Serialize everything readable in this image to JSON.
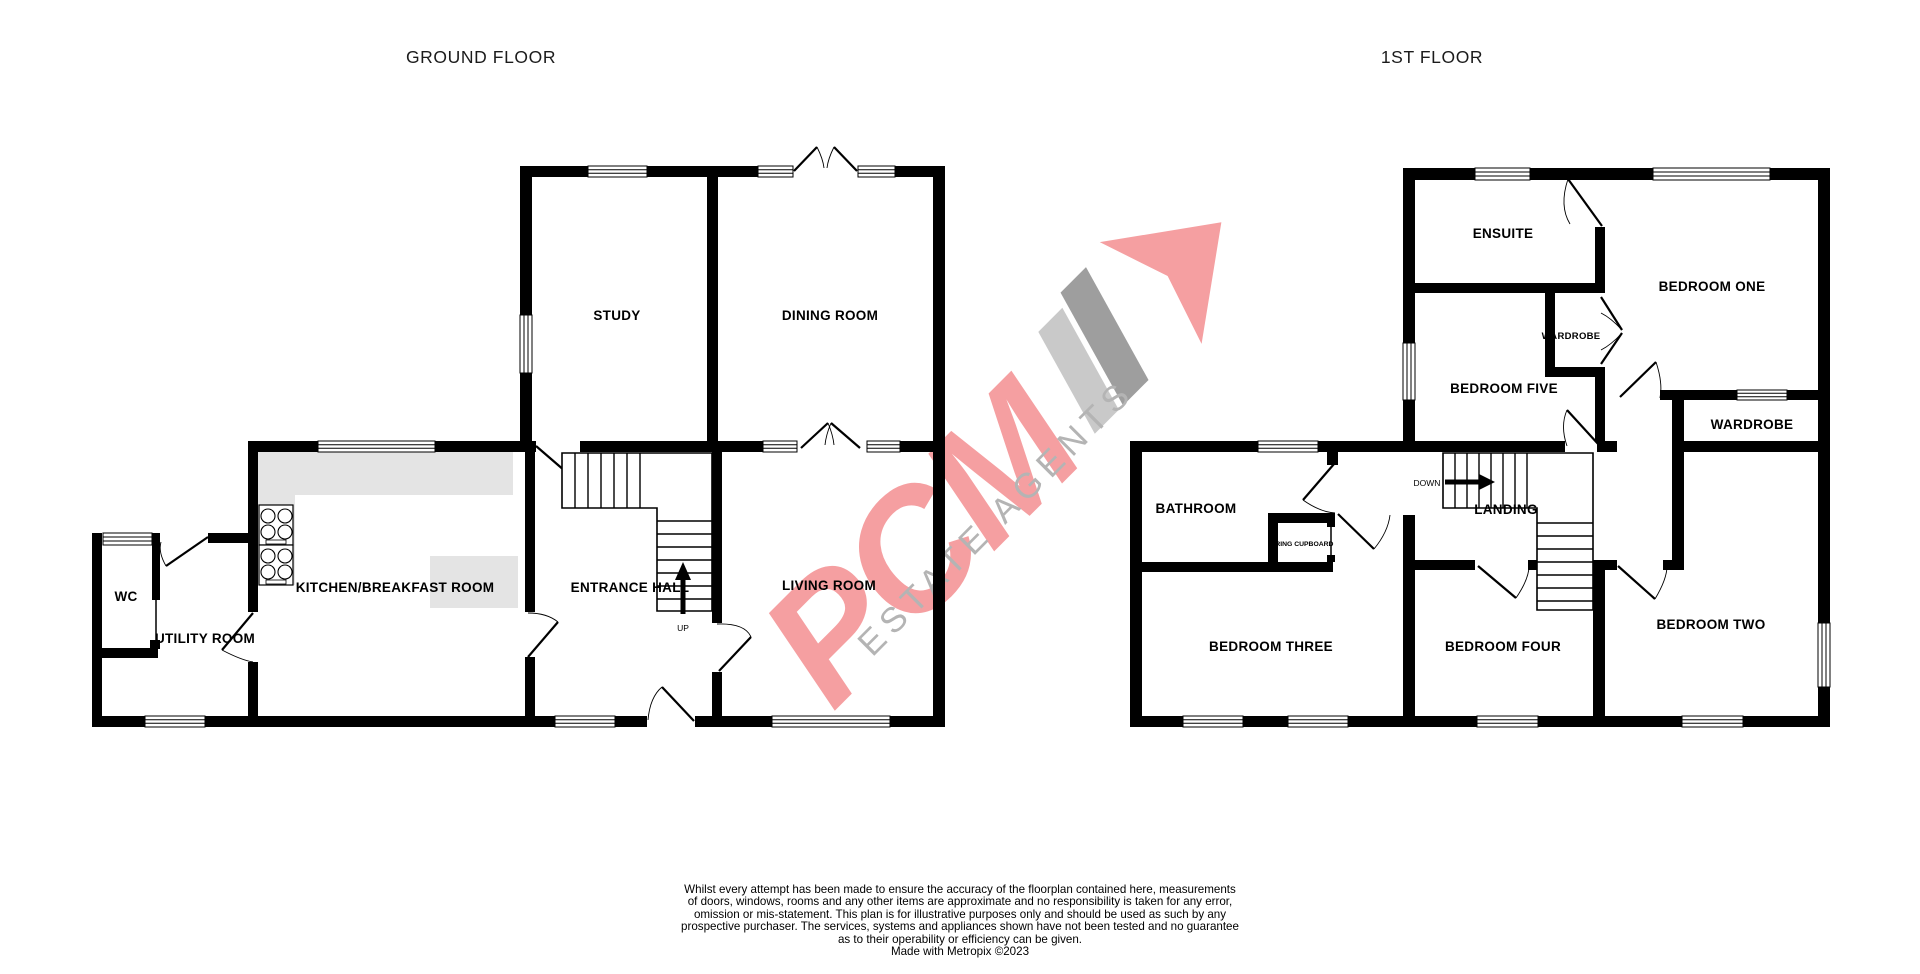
{
  "floors": {
    "ground": {
      "title": "GROUND FLOOR",
      "rooms": {
        "study": "STUDY",
        "dining": "DINING ROOM",
        "kitchen": "KITCHEN/BREAKFAST ROOM",
        "entrance": "ENTRANCE HALL",
        "living": "LIVING ROOM",
        "wc": "WC",
        "utility": "UTILITY ROOM"
      }
    },
    "first": {
      "title": "1ST FLOOR",
      "rooms": {
        "ensuite": "ENSUITE",
        "bedroom_one": "BEDROOM ONE",
        "wardrobe_small": "WARDROBE",
        "bedroom_five": "BEDROOM FIVE",
        "wardrobe_right": "WARDROBE",
        "bathroom": "BATHROOM",
        "landing": "LANDING",
        "airing_cupboard": "AIRING CUPBOARD",
        "bedroom_three": "BEDROOM THREE",
        "bedroom_four": "BEDROOM FOUR",
        "bedroom_two": "BEDROOM TWO"
      }
    }
  },
  "stairs": {
    "up": "UP",
    "down": "DOWN"
  },
  "watermark": {
    "brand": "PCM",
    "tagline": "ESTATE AGENTS",
    "colors": {
      "brand_pink": "#f59fa1",
      "tagline_grey": "#b4b4b4",
      "bar_light": "#c9c9c9",
      "bar_dark": "#9e9e9e"
    }
  },
  "footer": {
    "lines": [
      "Whilst every attempt has been made to ensure the accuracy of the floorplan contained here, measurements",
      "of doors, windows, rooms and any other items are approximate and no responsibility is taken for any error,",
      "omission or mis-statement. This plan is for illustrative purposes only and should be used as such by any",
      "prospective purchaser. The services, systems and appliances shown have not been tested and no guarantee",
      "as to their operability or efficiency can be given.",
      "Made with Metropix ©2023"
    ]
  }
}
